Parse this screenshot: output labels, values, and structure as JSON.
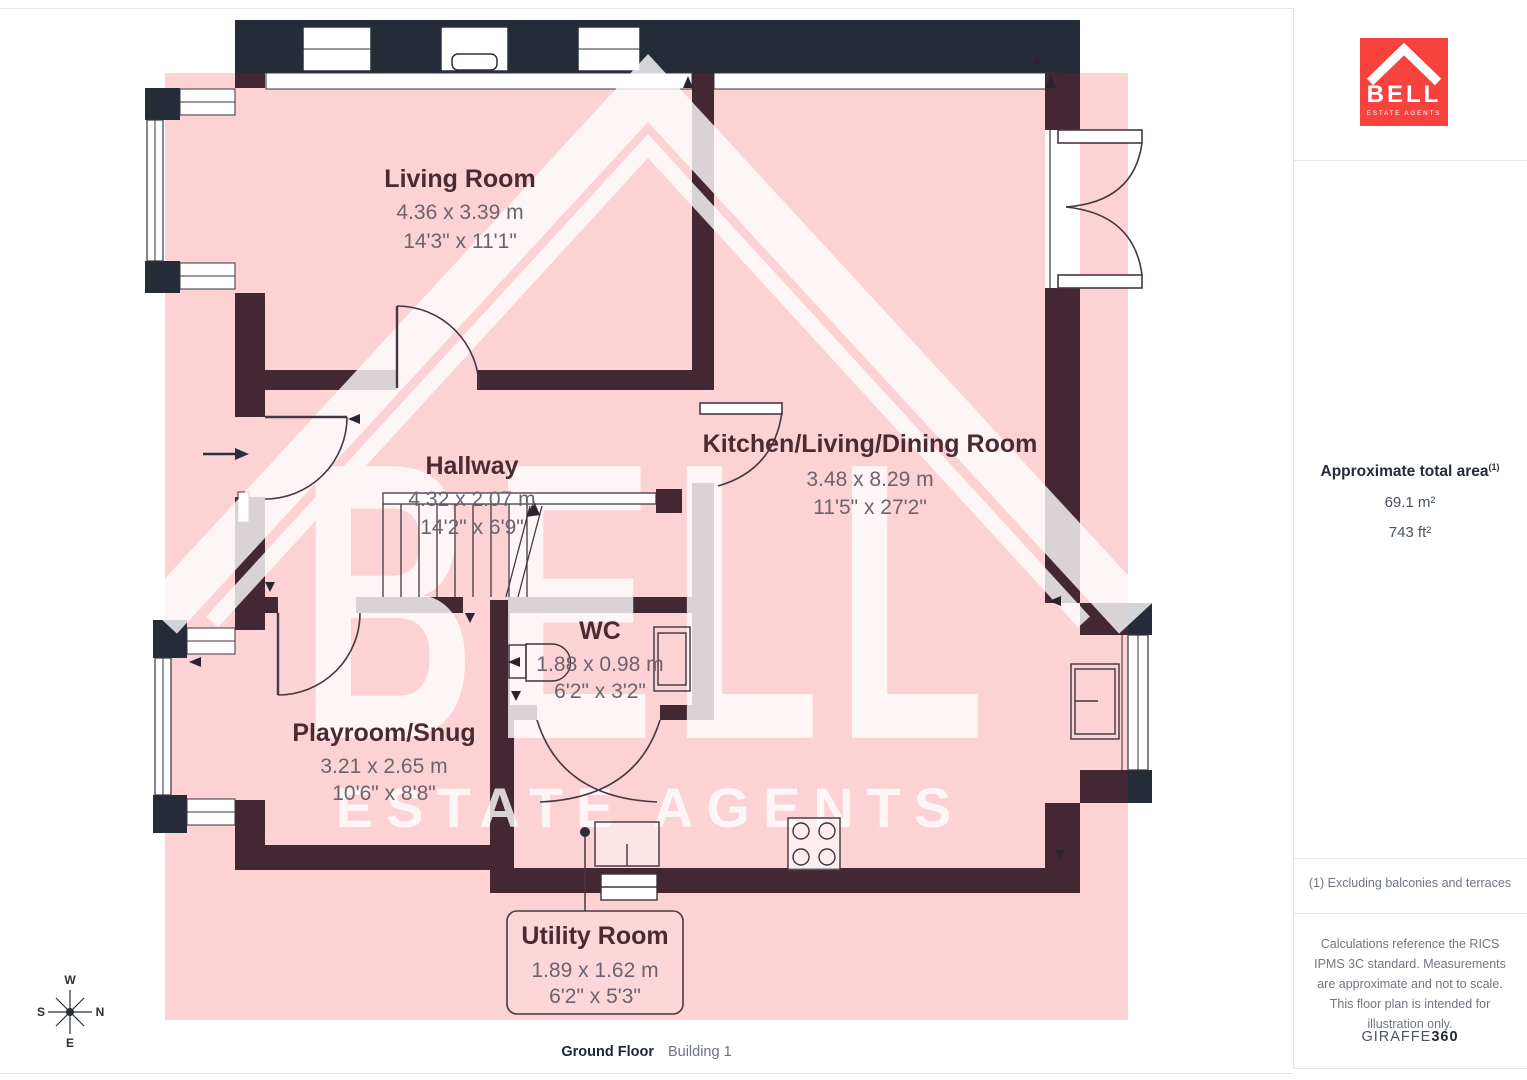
{
  "floorplan": {
    "rooms": [
      {
        "name": "Living Room",
        "metric": "4.36 x 3.39 m",
        "imperial": "14'3\" x 11'1\""
      },
      {
        "name": "Hallway",
        "metric": "4.32 x 2.07 m",
        "imperial": "14'2\" x 6'9\""
      },
      {
        "name": "Kitchen/Living/Dining Room",
        "metric": "3.48 x 8.29 m",
        "imperial": "11'5\" x 27'2\""
      },
      {
        "name": "WC",
        "metric": "1.88 x 0.98 m",
        "imperial": "6'2\" x 3'2\""
      },
      {
        "name": "Playroom/Snug",
        "metric": "3.21 x 2.65 m",
        "imperial": "10'6\" x 8'8\""
      },
      {
        "name": "Utility Room",
        "metric": "1.89 x 1.62 m",
        "imperial": "6'2\" x 5'3\""
      }
    ],
    "compass": {
      "top": "W",
      "right": "N",
      "bottom": "E",
      "left": "S"
    },
    "watermark": {
      "line1": "BELL",
      "line2": "ESTATE AGENTS"
    }
  },
  "footer": {
    "floor_label": "Ground Floor",
    "building_label": "Building 1"
  },
  "sidebar": {
    "logo": {
      "name": "BELL",
      "tagline": "ESTATE AGENTS"
    },
    "area": {
      "title": "Approximate total area",
      "superscript": "(1)",
      "metric": "69.1 m²",
      "imperial": "743 ft²"
    },
    "footnote": "(1) Excluding balconies and terraces",
    "disclaimer": "Calculations reference the RICS IPMS 3C standard. Measurements are approximate and not to scale. This floor plan is intended for illustration only.",
    "brand": {
      "name": "GIRAFFE",
      "suffix": "360"
    }
  },
  "colors": {
    "pink_overlay": "#fcd2d5",
    "wall_interior": "#432733",
    "wall_exterior": "#262b38",
    "brand_red": "#f8423d"
  }
}
